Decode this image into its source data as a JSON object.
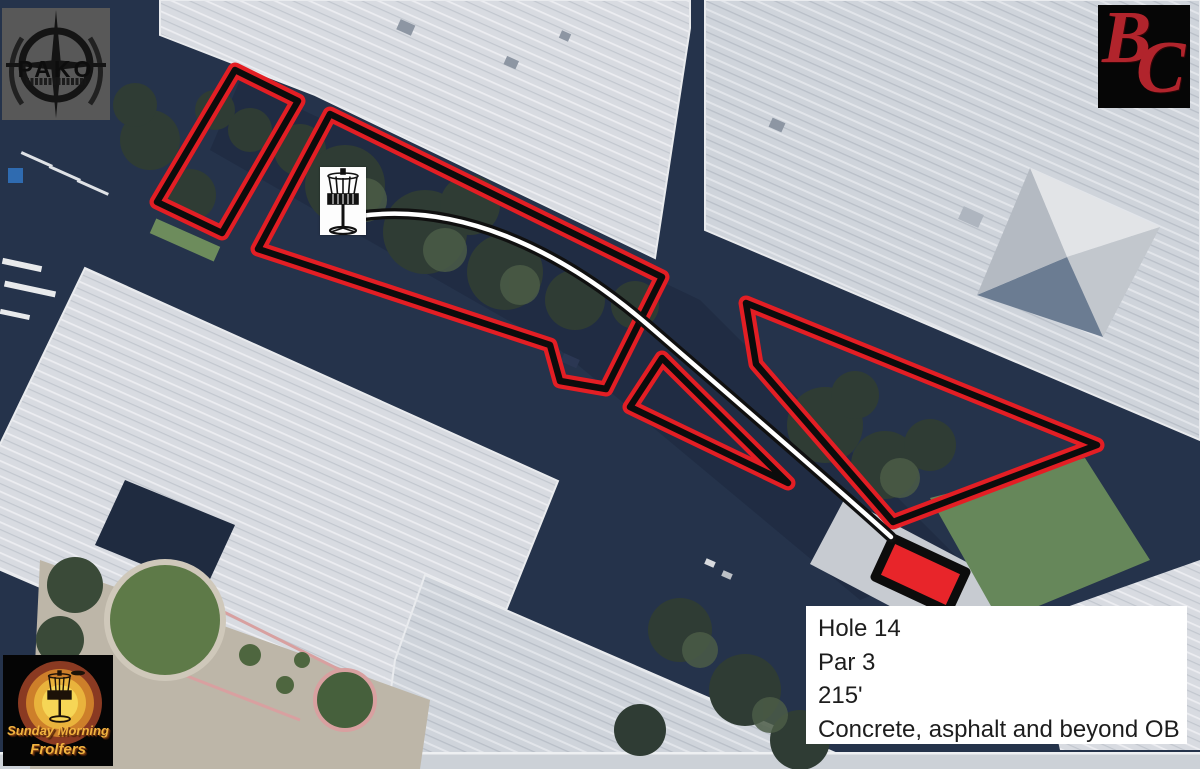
{
  "colors": {
    "ob_red": "#e31e24",
    "ob_black": "#0c0c0c",
    "path_white": "#ffffff",
    "path_black": "#101010",
    "tee_fill": "#e8252a",
    "info_bg": "#ffffff",
    "info_text": "#1d1d1d",
    "bc_red": "#b1242c",
    "smf_gold": "#f2b33f",
    "pako_bg": "#585858"
  },
  "hole_info": {
    "hole": "Hole 14",
    "par": "Par 3",
    "distance": "215'",
    "ob_note": "Concrete, asphalt and beyond OB"
  },
  "logos": {
    "pako": {
      "name": "PAKO"
    },
    "bc": {
      "b": "B",
      "c": "C"
    },
    "smf": {
      "line1": "Sunday Morning",
      "line2": "Frolfers"
    }
  },
  "overlay": {
    "stroke": {
      "red": "#e31e24",
      "red_width": 15,
      "black": "#0c0c0c",
      "black_width": 6.5
    },
    "ob_zones": [
      {
        "points": "235,70 298,101 222,233 157,202"
      },
      {
        "points": "330,114 662,277 606,389 560,381 550,345 258,249"
      },
      {
        "points": "662,358 788,483 630,407"
      },
      {
        "points": "746,303 1097,445 893,522 756,364"
      }
    ],
    "tee_pad": {
      "points": "893,538 966,572 948,611 875,577",
      "fill": "#e8252a",
      "border": "#0c0c0c",
      "border_width": 9
    },
    "flight_path": {
      "d": "M 360 216 C 455 203 555 245 648 325 C 735 400 845 495 891 537",
      "casing_width": 11,
      "core_width": 4.5
    }
  }
}
